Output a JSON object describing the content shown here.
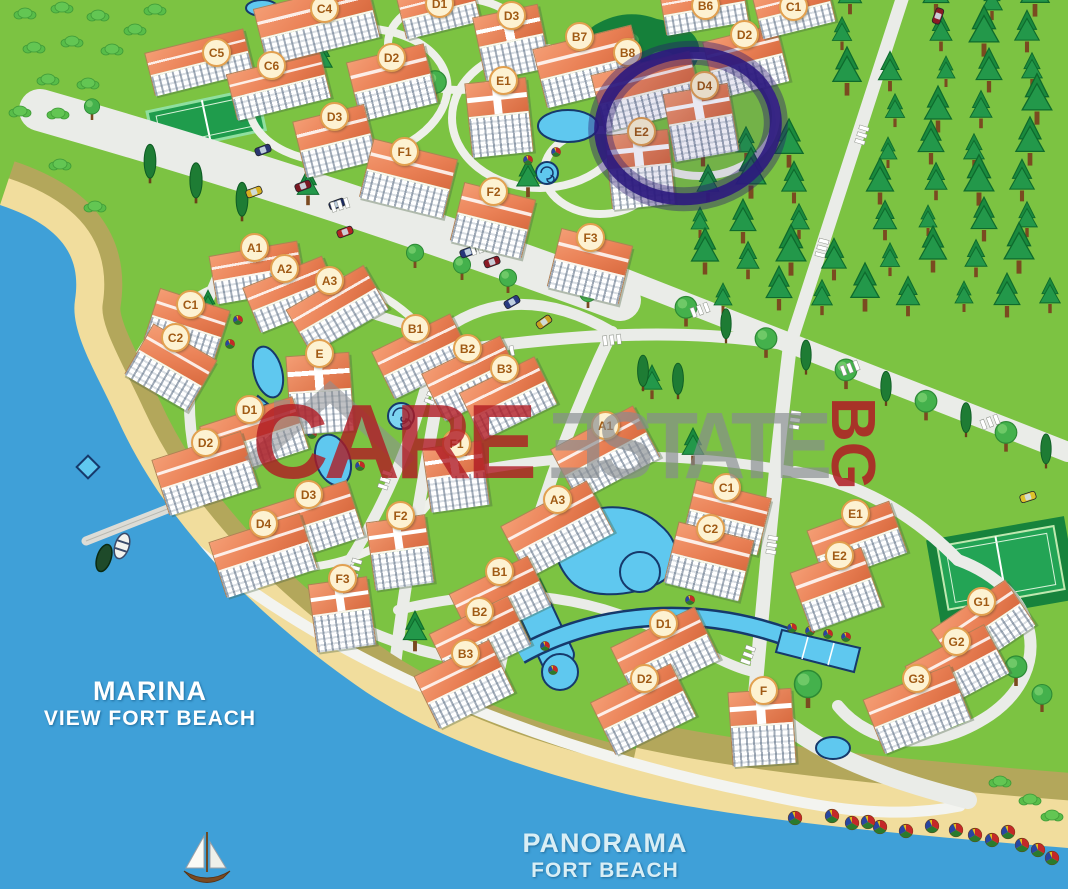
{
  "watermark": {
    "care": "CARE",
    "estate": "ƎSTATE",
    "bg": "BG"
  },
  "sea_labels": {
    "marina_line1": "MARINA",
    "marina_line2": "VIEW FORT BEACH",
    "panorama_line1": "PANORAMA",
    "panorama_line2": "FORT BEACH"
  },
  "highlight": {
    "building": "D4",
    "complex": "upper-resort",
    "marker_color": "#2c1a7e"
  },
  "complexes": [
    {
      "name": "upper-resort",
      "buildings": [
        {
          "label": "C5",
          "badge": [
            215,
            51
          ],
          "box": [
            148,
            40,
            100,
            42
          ],
          "rot": -14,
          "kind": "slab"
        },
        {
          "label": "C6",
          "badge": [
            270,
            64
          ],
          "box": [
            230,
            62,
            95,
            45
          ],
          "rot": -14,
          "kind": "slab"
        },
        {
          "label": "C4",
          "badge": [
            323,
            7
          ],
          "box": [
            258,
            -6,
            115,
            55
          ],
          "rot": -14,
          "kind": "slab",
          "cut": true
        },
        {
          "label": "D1",
          "badge": [
            438,
            2
          ],
          "box": [
            400,
            -12,
            75,
            40
          ],
          "rot": -14,
          "kind": "slab",
          "cut": true
        },
        {
          "label": "D2",
          "badge": [
            390,
            56
          ],
          "box": [
            352,
            52,
            78,
            58
          ],
          "rot": -14,
          "kind": "slab"
        },
        {
          "label": "D3",
          "badge": [
            510,
            14
          ],
          "box": [
            478,
            10,
            65,
            62
          ],
          "rot": -12,
          "kind": "tower"
        },
        {
          "label": "D3",
          "badge": [
            333,
            115
          ],
          "box": [
            298,
            112,
            72,
            55
          ],
          "rot": -14,
          "kind": "slab"
        },
        {
          "label": "F1",
          "badge": [
            403,
            150
          ],
          "box": [
            365,
            148,
            85,
            58
          ],
          "rot": 14,
          "kind": "slab"
        },
        {
          "label": "B7",
          "badge": [
            578,
            35
          ],
          "box": [
            538,
            36,
            100,
            58
          ],
          "rot": -14,
          "kind": "slab"
        },
        {
          "label": "B8",
          "badge": [
            626,
            51
          ],
          "box": [
            596,
            62,
            100,
            56
          ],
          "rot": -14,
          "kind": "slab"
        },
        {
          "label": "E1",
          "badge": [
            502,
            79
          ],
          "box": [
            468,
            80,
            60,
            72
          ],
          "rot": -6,
          "kind": "tower"
        },
        {
          "label": "E2",
          "badge": [
            640,
            130
          ],
          "box": [
            608,
            132,
            62,
            72
          ],
          "rot": -6,
          "kind": "tower"
        },
        {
          "label": "D2",
          "badge": [
            743,
            33
          ],
          "box": [
            708,
            32,
            74,
            56
          ],
          "rot": -14,
          "kind": "slab"
        },
        {
          "label": "D4",
          "badge": [
            703,
            84
          ],
          "box": [
            668,
            88,
            64,
            66
          ],
          "rot": -10,
          "kind": "tower",
          "highlight": true
        },
        {
          "label": "B6",
          "badge": [
            704,
            4
          ],
          "box": [
            662,
            -14,
            82,
            40
          ],
          "rot": -10,
          "kind": "slab",
          "cut": true
        },
        {
          "label": "C1",
          "badge": [
            792,
            5
          ],
          "box": [
            756,
            -12,
            74,
            40
          ],
          "rot": -14,
          "kind": "slab",
          "cut": true
        },
        {
          "label": "F2",
          "badge": [
            492,
            190
          ],
          "box": [
            456,
            190,
            72,
            58
          ],
          "rot": 14,
          "kind": "slab"
        },
        {
          "label": "F3",
          "badge": [
            589,
            236
          ],
          "box": [
            553,
            236,
            72,
            58
          ],
          "rot": 14,
          "kind": "slab"
        }
      ]
    },
    {
      "name": "marina-view",
      "buildings": [
        {
          "label": "A1",
          "badge": [
            253,
            246
          ],
          "box": [
            212,
            248,
            88,
            46
          ],
          "rot": -10,
          "kind": "slab"
        },
        {
          "label": "A2",
          "badge": [
            283,
            267
          ],
          "box": [
            248,
            270,
            84,
            46
          ],
          "rot": -22,
          "kind": "slab"
        },
        {
          "label": "A3",
          "badge": [
            328,
            279
          ],
          "box": [
            292,
            284,
            88,
            48
          ],
          "rot": -30,
          "kind": "slab"
        },
        {
          "label": "C1",
          "badge": [
            189,
            303
          ],
          "box": [
            150,
            298,
            72,
            52
          ],
          "rot": 18,
          "kind": "slab"
        },
        {
          "label": "C2",
          "badge": [
            174,
            336
          ],
          "box": [
            134,
            338,
            72,
            56
          ],
          "rot": 30,
          "kind": "slab"
        },
        {
          "label": "B1",
          "badge": [
            414,
            327
          ],
          "box": [
            378,
            330,
            86,
            50
          ],
          "rot": -26,
          "kind": "slab"
        },
        {
          "label": "B2",
          "badge": [
            466,
            347
          ],
          "box": [
            428,
            352,
            86,
            50
          ],
          "rot": -26,
          "kind": "slab"
        },
        {
          "label": "B3",
          "badge": [
            503,
            367
          ],
          "box": [
            466,
            372,
            82,
            50
          ],
          "rot": -26,
          "kind": "slab"
        },
        {
          "label": "E",
          "badge": [
            318,
            352
          ],
          "box": [
            288,
            354,
            62,
            76
          ],
          "rot": -4,
          "kind": "tower"
        },
        {
          "label": "D1",
          "badge": [
            248,
            408
          ],
          "box": [
            205,
            410,
            96,
            52
          ],
          "rot": -18,
          "kind": "slab"
        },
        {
          "label": "D2",
          "badge": [
            204,
            441
          ],
          "box": [
            158,
            444,
            92,
            56
          ],
          "rot": -18,
          "kind": "slab"
        },
        {
          "label": "D3",
          "badge": [
            307,
            493
          ],
          "box": [
            258,
            494,
            98,
            56
          ],
          "rot": -18,
          "kind": "slab"
        },
        {
          "label": "D4",
          "badge": [
            262,
            522
          ],
          "box": [
            215,
            526,
            94,
            56
          ],
          "rot": -18,
          "kind": "slab"
        },
        {
          "label": "F1",
          "badge": [
            455,
            442
          ],
          "box": [
            426,
            444,
            58,
            62
          ],
          "rot": -8,
          "kind": "tower"
        },
        {
          "label": "F2",
          "badge": [
            399,
            514
          ],
          "box": [
            370,
            518,
            58,
            66
          ],
          "rot": -8,
          "kind": "tower"
        },
        {
          "label": "F3",
          "badge": [
            341,
            577
          ],
          "box": [
            312,
            580,
            58,
            66
          ],
          "rot": -8,
          "kind": "tower"
        }
      ]
    },
    {
      "name": "panorama",
      "buildings": [
        {
          "label": "A1",
          "badge": [
            604,
            424
          ],
          "box": [
            558,
            424,
            92,
            56
          ],
          "rot": -28,
          "kind": "slab"
        },
        {
          "label": "A3",
          "badge": [
            556,
            498
          ],
          "box": [
            508,
            500,
            96,
            56
          ],
          "rot": -28,
          "kind": "slab"
        },
        {
          "label": "C1",
          "badge": [
            725,
            486
          ],
          "box": [
            688,
            488,
            76,
            56
          ],
          "rot": 14,
          "kind": "slab"
        },
        {
          "label": "C2",
          "badge": [
            709,
            527
          ],
          "box": [
            670,
            530,
            76,
            60
          ],
          "rot": 14,
          "kind": "slab"
        },
        {
          "label": "B1",
          "badge": [
            498,
            570
          ],
          "box": [
            456,
            572,
            86,
            52
          ],
          "rot": -26,
          "kind": "slab"
        },
        {
          "label": "B2",
          "badge": [
            478,
            610
          ],
          "box": [
            436,
            612,
            86,
            52
          ],
          "rot": -26,
          "kind": "slab"
        },
        {
          "label": "B3",
          "badge": [
            464,
            652
          ],
          "box": [
            422,
            655,
            82,
            56
          ],
          "rot": -26,
          "kind": "slab"
        },
        {
          "label": "D1",
          "badge": [
            662,
            622
          ],
          "box": [
            618,
            624,
            92,
            56
          ],
          "rot": -26,
          "kind": "slab"
        },
        {
          "label": "D2",
          "badge": [
            643,
            677
          ],
          "box": [
            598,
            680,
            88,
            56
          ],
          "rot": -26,
          "kind": "slab"
        },
        {
          "label": "F",
          "badge": [
            762,
            689
          ],
          "box": [
            730,
            690,
            62,
            72
          ],
          "rot": -4,
          "kind": "tower"
        },
        {
          "label": "E1",
          "badge": [
            854,
            512
          ],
          "box": [
            813,
            514,
            86,
            52
          ],
          "rot": -20,
          "kind": "slab"
        },
        {
          "label": "E2",
          "badge": [
            838,
            554
          ],
          "box": [
            798,
            558,
            74,
            60
          ],
          "rot": -20,
          "kind": "slab"
        },
        {
          "label": "G1",
          "badge": [
            980,
            600
          ],
          "box": [
            938,
            600,
            88,
            52
          ],
          "rot": -34,
          "kind": "slab"
        },
        {
          "label": "G2",
          "badge": [
            955,
            640
          ],
          "box": [
            912,
            642,
            88,
            52
          ],
          "rot": -28,
          "kind": "slab"
        },
        {
          "label": "G3",
          "badge": [
            915,
            677
          ],
          "box": [
            870,
            680,
            92,
            56
          ],
          "rot": -22,
          "kind": "slab"
        }
      ]
    }
  ],
  "colors": {
    "sea": "#3fa0d8",
    "sand": "#f1dd9d",
    "dune": "#b3a75b",
    "grass": "#7cc342",
    "forest_green": "#1d8a3f",
    "road": "#eaece8",
    "roof": "#ec8660",
    "roof_edge": "#c2603a",
    "wall": "#f7f6f0",
    "badge_bg": "#fdf2d2",
    "badge_border": "#e2a04f",
    "badge_text": "#a05a14",
    "pool": "#5fc8ef",
    "pool_edge": "#16396b",
    "marker_purple": "#2c1a7e",
    "watermark_red": "#b01b24",
    "watermark_gray": "#878c90",
    "court_green": "#21a04f",
    "label_white": "#ffffff",
    "label_blue": "#d9eef5"
  }
}
